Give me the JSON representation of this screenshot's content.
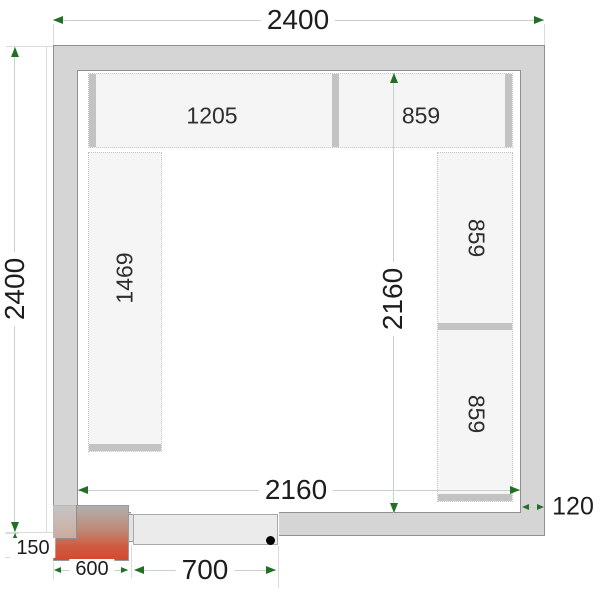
{
  "diagram": {
    "type": "cold-room-floor-plan",
    "outer": {
      "width_label": "2400",
      "height_label": "2400"
    },
    "inner": {
      "width_label": "2160",
      "depth_label": "2160"
    },
    "wall": {
      "thickness_label": "120"
    },
    "cooling_unit": {
      "width_label": "600",
      "protrusion_label": "150"
    },
    "door": {
      "width_label": "700"
    },
    "shelves": {
      "top_left_label": "1205",
      "top_right_label": "859",
      "left_label": "1469",
      "right_upper_label": "859",
      "right_lower_label": "859"
    },
    "colors": {
      "wall_fill": "#d5d5d5",
      "wall_border": "#8f8f8f",
      "shelf_fill": "#f5f5f5",
      "shelf_border": "#c6c6c6",
      "shelf_strip": "#c3c3c3",
      "dim_line": "#c7d3c7",
      "arrow_green": "#226f26",
      "text": "#1d1d1d",
      "door_fill": "#ebebeb",
      "unit_gradient_top": "#b0b0ae",
      "unit_gradient_bottom": "#d4492e"
    }
  }
}
